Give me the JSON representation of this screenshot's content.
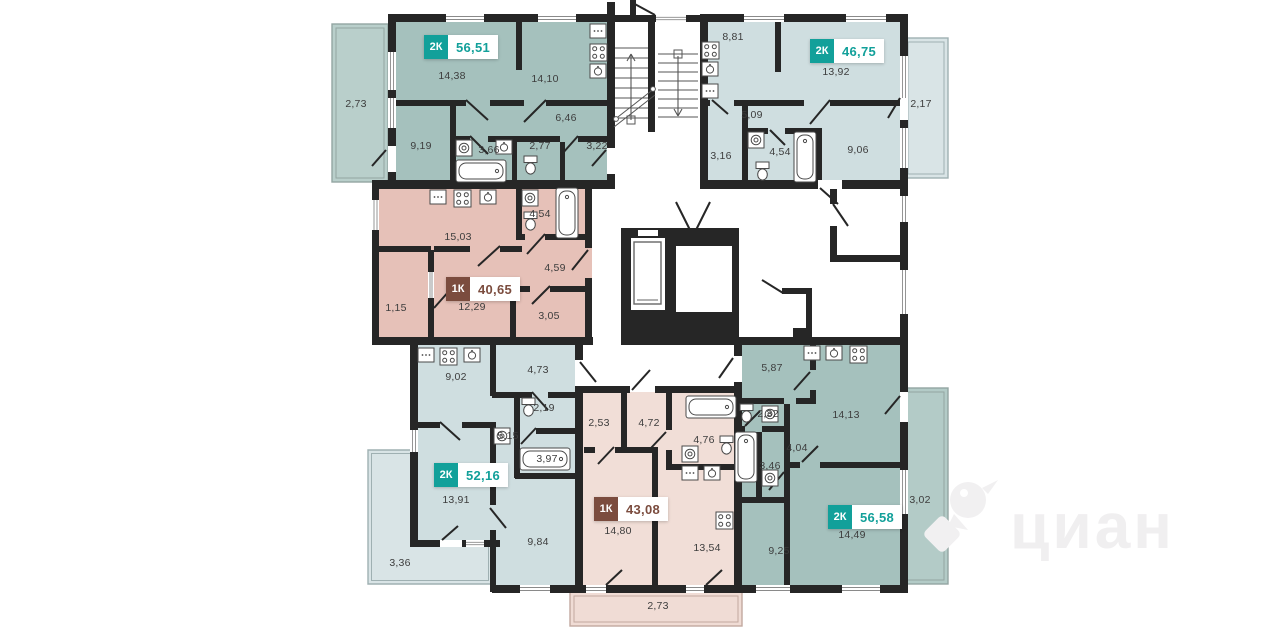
{
  "watermark": {
    "text": "циан",
    "logo": "cian-bird-logo",
    "color": "#f0eff0"
  },
  "colors": {
    "wall": "#262626",
    "teal_badge": "#12a09a",
    "brown_badge": "#7b4c3e",
    "teal_fill": "#a5c1bd",
    "blue_fill": "#cfdee0",
    "pink_fill": "#e6c1b8",
    "light_pink_fill": "#f1ded7"
  },
  "apartments": [
    {
      "id": "top-left",
      "type": "2К",
      "area": "56,51",
      "palette": "teal",
      "rooms": [
        "2,73",
        "14,38",
        "14,10",
        "6,46",
        "9,19",
        "3,66",
        "2,77",
        "3,22"
      ]
    },
    {
      "id": "top-right",
      "type": "2К",
      "area": "46,75",
      "palette": "teal",
      "rooms": [
        "8,81",
        "13,92",
        "2,17",
        "5,09",
        "3,16",
        "4,54",
        "9,06"
      ]
    },
    {
      "id": "mid-left",
      "type": "1К",
      "area": "40,65",
      "palette": "brown",
      "rooms": [
        "15,03",
        "4,54",
        "4,59",
        "1,15",
        "12,29",
        "3,05"
      ]
    },
    {
      "id": "bottom-left",
      "type": "2К",
      "area": "52,16",
      "palette": "teal",
      "rooms": [
        "9,02",
        "4,73",
        "2,19",
        "5,15",
        "3,97",
        "13,91",
        "9,84",
        "3,36"
      ]
    },
    {
      "id": "bottom-middle",
      "type": "1К",
      "area": "43,08",
      "palette": "brown",
      "rooms": [
        "2,53",
        "4,72",
        "4,76",
        "14,80",
        "13,54",
        "2,73"
      ]
    },
    {
      "id": "bottom-right",
      "type": "2К",
      "area": "56,58",
      "palette": "teal",
      "rooms": [
        "5,87",
        "2,32",
        "14,13",
        "4,04",
        "3,46",
        "14,49",
        "9,25",
        "3,02"
      ]
    }
  ]
}
